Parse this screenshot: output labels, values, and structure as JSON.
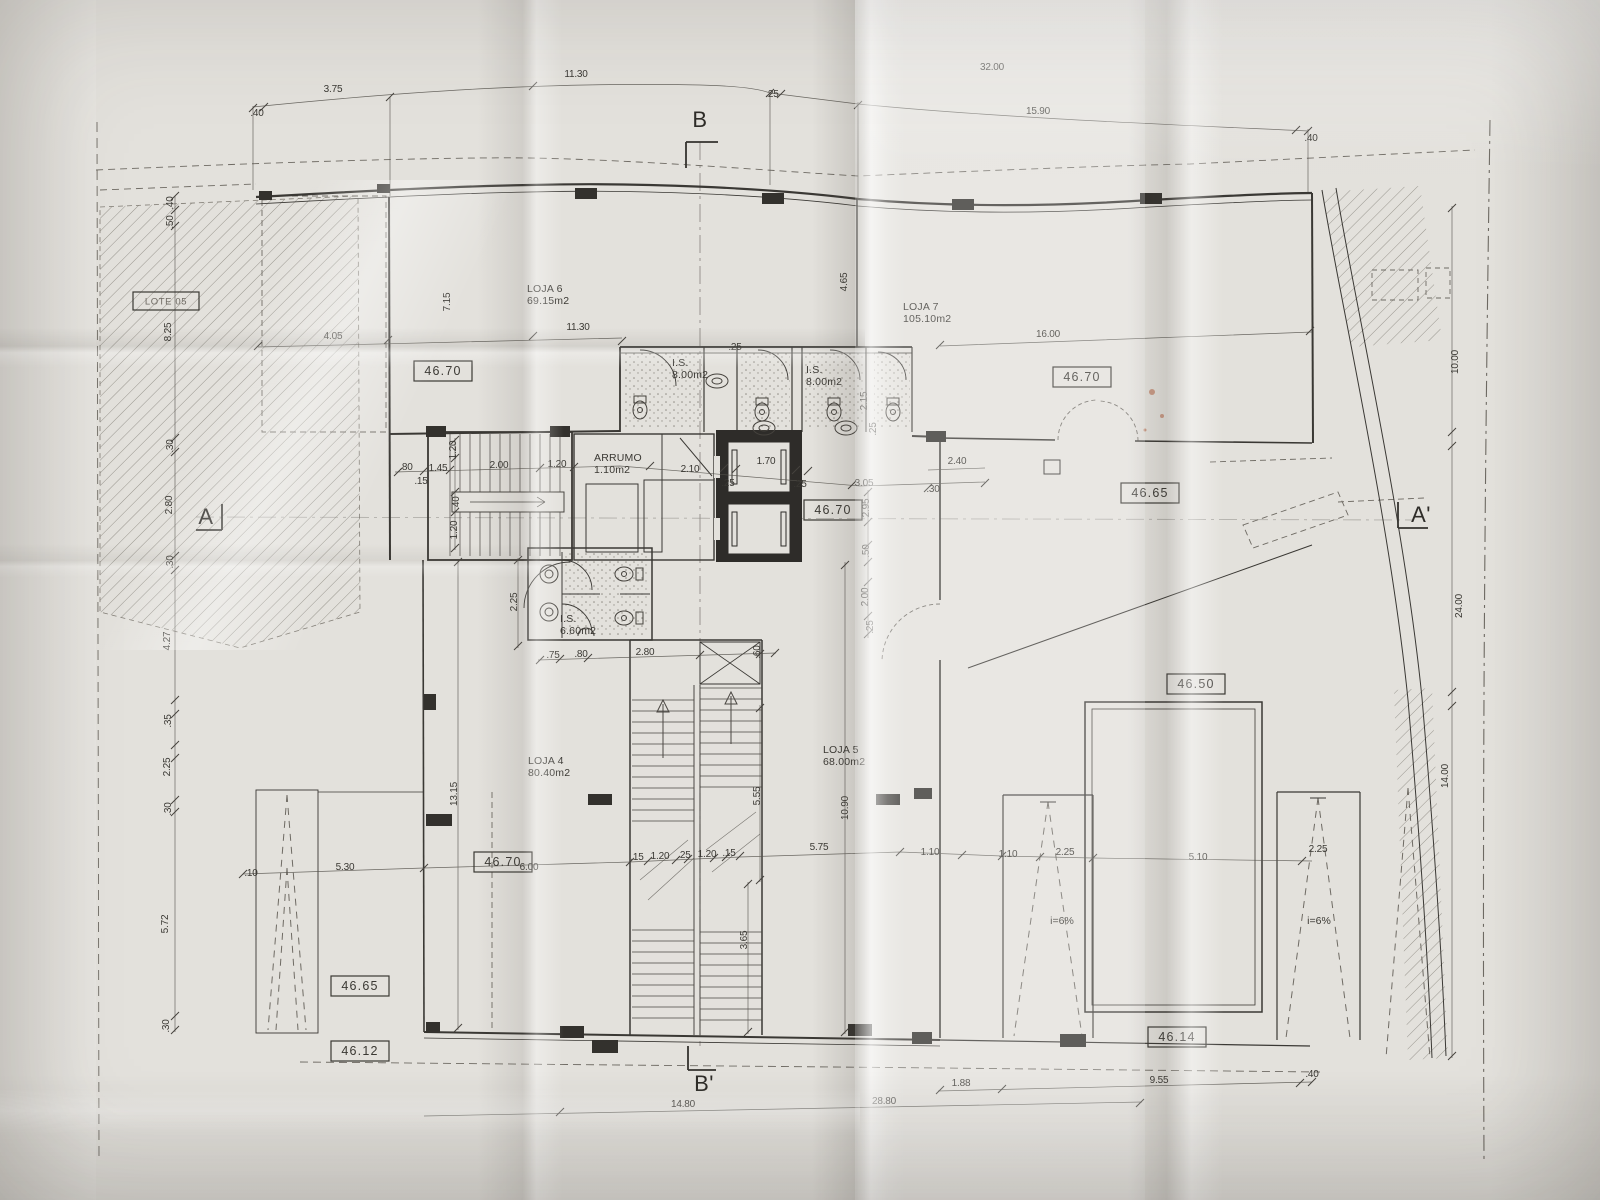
{
  "drawing": {
    "section_markers": [
      {
        "label": "B",
        "x": 700,
        "y": 127
      },
      {
        "label": "B'",
        "x": 704,
        "y": 1091
      },
      {
        "label": "A",
        "x": 206,
        "y": 524
      },
      {
        "label": "A'",
        "x": 1421,
        "y": 522
      }
    ],
    "elevation_markers": [
      {
        "value": "46.70",
        "x": 443,
        "y": 371
      },
      {
        "value": "46.70",
        "x": 1082,
        "y": 377
      },
      {
        "value": "46.65",
        "x": 1150,
        "y": 493
      },
      {
        "value": "46.70",
        "x": 833,
        "y": 510
      },
      {
        "value": "46.70",
        "x": 503,
        "y": 862
      },
      {
        "value": "46.65",
        "x": 360,
        "y": 986
      },
      {
        "value": "46.12",
        "x": 360,
        "y": 1051
      },
      {
        "value": "46.50",
        "x": 1196,
        "y": 684
      },
      {
        "value": "46.14",
        "x": 1177,
        "y": 1037
      }
    ],
    "parcel_label": {
      "value": "LOTE 05",
      "x": 166,
      "y": 301
    },
    "rooms": [
      {
        "name": "LOJA 6",
        "area": "69.15m2",
        "x": 527,
        "y": 292
      },
      {
        "name": "LOJA 7",
        "area": "105.10m2",
        "x": 903,
        "y": 310
      },
      {
        "name": "LOJA 4",
        "area": "80.40m2",
        "x": 528,
        "y": 764
      },
      {
        "name": "LOJA 5",
        "area": "68.00m2",
        "x": 823,
        "y": 753
      },
      {
        "name": "I.S.",
        "area": "8.00m2",
        "x": 672,
        "y": 366
      },
      {
        "name": "I.S.",
        "area": "8.00m2",
        "x": 806,
        "y": 373
      },
      {
        "name": "I.S.",
        "area": "6.60m2",
        "x": 560,
        "y": 622
      },
      {
        "name": "ARRUMO",
        "area": "1.10m2",
        "x": 594,
        "y": 461
      }
    ],
    "slope_labels": [
      {
        "text": "i=6%",
        "x": 1062,
        "y": 924
      },
      {
        "text": "i=6%",
        "x": 1319,
        "y": 924
      }
    ],
    "dimensions": [
      {
        "text": ".40",
        "x": 257,
        "y": 116
      },
      {
        "text": "3.75",
        "x": 333,
        "y": 92
      },
      {
        "text": "11.30",
        "x": 576,
        "y": 77
      },
      {
        "text": "32.00",
        "x": 992,
        "y": 70
      },
      {
        "text": ".25",
        "x": 772,
        "y": 97
      },
      {
        "text": "15.90",
        "x": 1038,
        "y": 114
      },
      {
        "text": ".40",
        "x": 1311,
        "y": 141
      },
      {
        "text": "4.05",
        "x": 333,
        "y": 339
      },
      {
        "text": "11.30",
        "x": 578,
        "y": 330
      },
      {
        "text": "16.00",
        "x": 1048,
        "y": 337
      },
      {
        "text": "7.15",
        "x": 450,
        "y": 302,
        "rot": 90
      },
      {
        "text": "4.65",
        "x": 847,
        "y": 282,
        "rot": 90
      },
      {
        "text": ".40",
        "x": 173,
        "y": 203,
        "rot": 90
      },
      {
        "text": ".50",
        "x": 173,
        "y": 222,
        "rot": 90
      },
      {
        "text": "8.25",
        "x": 171,
        "y": 332,
        "rot": 90
      },
      {
        "text": ".30",
        "x": 173,
        "y": 446,
        "rot": 90
      },
      {
        "text": "2.80",
        "x": 172,
        "y": 505,
        "rot": 90
      },
      {
        "text": ".30",
        "x": 173,
        "y": 562,
        "rot": 90
      },
      {
        "text": "4.27",
        "x": 170,
        "y": 641,
        "rot": 90
      },
      {
        "text": ".35",
        "x": 171,
        "y": 721,
        "rot": 90
      },
      {
        "text": "2.25",
        "x": 170,
        "y": 767,
        "rot": 90
      },
      {
        "text": ".30",
        "x": 171,
        "y": 809,
        "rot": 90
      },
      {
        "text": "5.72",
        "x": 168,
        "y": 924,
        "rot": 90
      },
      {
        "text": ".30",
        "x": 169,
        "y": 1026,
        "rot": 90
      },
      {
        "text": ".25",
        "x": 735,
        "y": 350
      },
      {
        "text": "2.15",
        "x": 867,
        "y": 401,
        "rot": 90
      },
      {
        "text": ".25",
        "x": 876,
        "y": 429,
        "rot": 90
      },
      {
        "text": ".80",
        "x": 406,
        "y": 470
      },
      {
        "text": "1.45",
        "x": 438,
        "y": 471
      },
      {
        "text": ".15",
        "x": 421,
        "y": 484
      },
      {
        "text": "1.20",
        "x": 456,
        "y": 450,
        "rot": 90
      },
      {
        "text": "2.00",
        "x": 499,
        "y": 468
      },
      {
        "text": "1.20",
        "x": 557,
        "y": 467
      },
      {
        "text": "2.10",
        "x": 690,
        "y": 472
      },
      {
        "text": ".25",
        "x": 728,
        "y": 486
      },
      {
        "text": "1.70",
        "x": 766,
        "y": 464
      },
      {
        "text": ".25",
        "x": 800,
        "y": 487
      },
      {
        "text": "3.05",
        "x": 864,
        "y": 486
      },
      {
        "text": ".30",
        "x": 933,
        "y": 492
      },
      {
        "text": "2.40",
        "x": 957,
        "y": 464
      },
      {
        "text": "2.95",
        "x": 869,
        "y": 508,
        "rot": 90
      },
      {
        "text": ".50",
        "x": 869,
        "y": 551,
        "rot": 90
      },
      {
        "text": "2.00",
        "x": 868,
        "y": 597,
        "rot": 90
      },
      {
        "text": ".25",
        "x": 873,
        "y": 627,
        "rot": 90
      },
      {
        "text": ".40",
        "x": 459,
        "y": 503,
        "rot": 90
      },
      {
        "text": "1.20",
        "x": 457,
        "y": 530,
        "rot": 90
      },
      {
        "text": "2.25",
        "x": 517,
        "y": 602,
        "rot": 90
      },
      {
        "text": ".75",
        "x": 553,
        "y": 658
      },
      {
        "text": ".80",
        "x": 581,
        "y": 657
      },
      {
        "text": "2.80",
        "x": 645,
        "y": 655
      },
      {
        "text": ".60",
        "x": 760,
        "y": 652,
        "rot": 90
      },
      {
        "text": "5.55",
        "x": 760,
        "y": 796,
        "rot": 90
      },
      {
        "text": "3.65",
        "x": 747,
        "y": 940,
        "rot": 90
      },
      {
        "text": "10.90",
        "x": 848,
        "y": 808,
        "rot": 90
      },
      {
        "text": "13.15",
        "x": 457,
        "y": 794,
        "rot": 90
      },
      {
        "text": ".10",
        "x": 251,
        "y": 876
      },
      {
        "text": "5.30",
        "x": 345,
        "y": 870
      },
      {
        "text": "6.00",
        "x": 529,
        "y": 870
      },
      {
        "text": ".15",
        "x": 637,
        "y": 860
      },
      {
        "text": "1.20",
        "x": 660,
        "y": 859
      },
      {
        "text": ".25",
        "x": 684,
        "y": 858
      },
      {
        "text": "1.20",
        "x": 707,
        "y": 857
      },
      {
        "text": ".15",
        "x": 729,
        "y": 856
      },
      {
        "text": "5.75",
        "x": 819,
        "y": 850
      },
      {
        "text": "1.10",
        "x": 930,
        "y": 855
      },
      {
        "text": "1.10",
        "x": 1008,
        "y": 857
      },
      {
        "text": "2.25",
        "x": 1065,
        "y": 855
      },
      {
        "text": "5.10",
        "x": 1198,
        "y": 860
      },
      {
        "text": "2.25",
        "x": 1318,
        "y": 852
      },
      {
        "text": "10.00",
        "x": 1458,
        "y": 362,
        "rot": 90
      },
      {
        "text": "24.00",
        "x": 1462,
        "y": 606,
        "rot": 90
      },
      {
        "text": "14.00",
        "x": 1448,
        "y": 776,
        "rot": 90
      },
      {
        "text": "1.88",
        "x": 961,
        "y": 1086
      },
      {
        "text": "9.55",
        "x": 1159,
        "y": 1083
      },
      {
        "text": ".40",
        "x": 1312,
        "y": 1077
      },
      {
        "text": "14.80",
        "x": 683,
        "y": 1107
      },
      {
        "text": "28.80",
        "x": 884,
        "y": 1104
      }
    ]
  }
}
